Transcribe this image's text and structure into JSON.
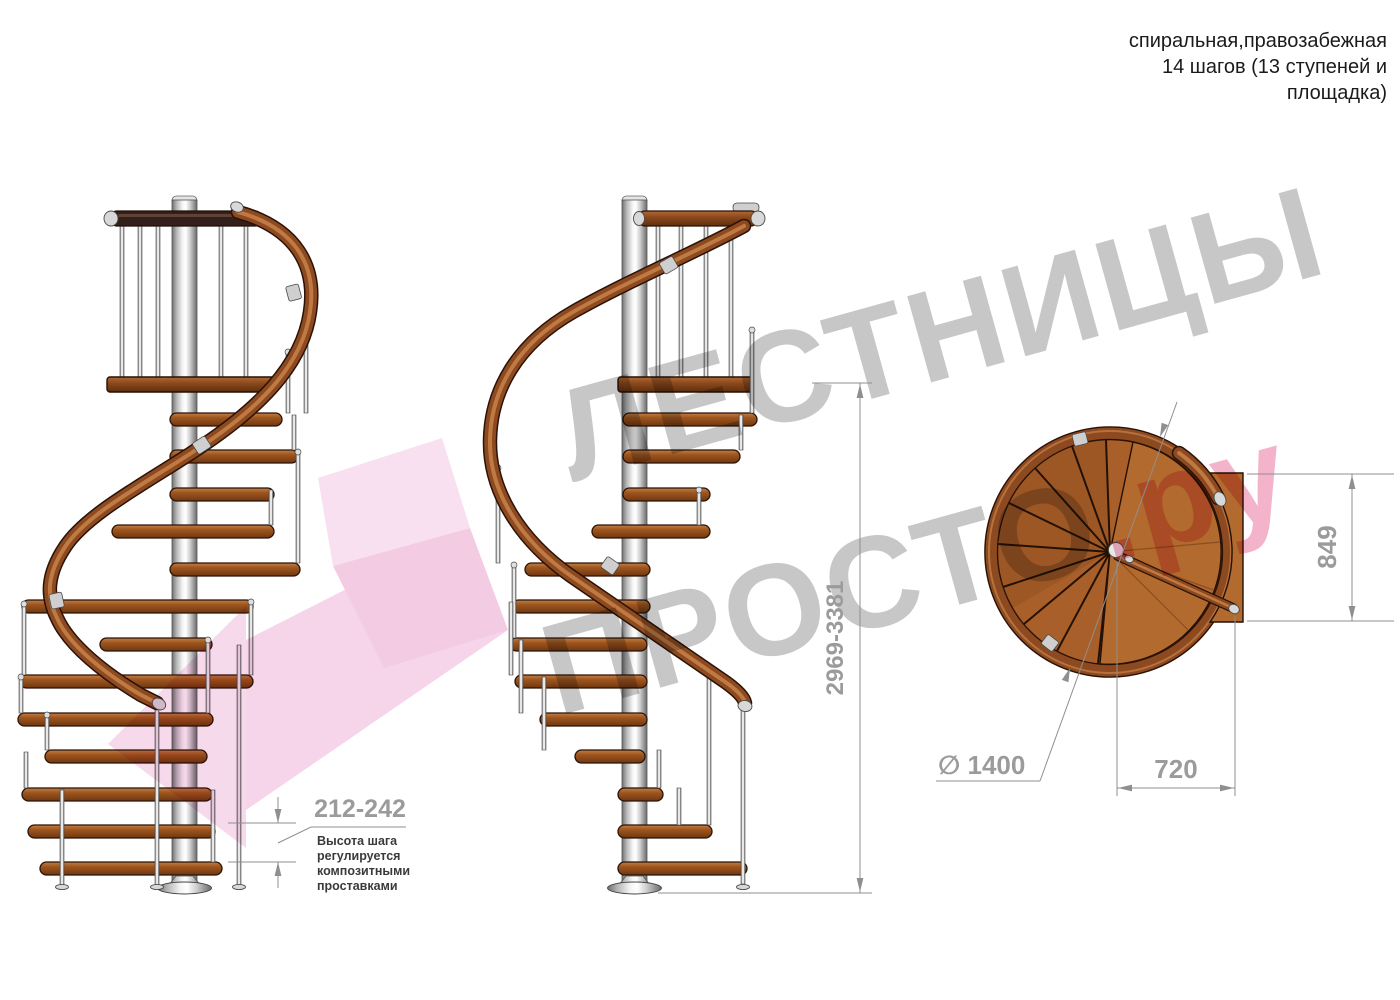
{
  "header": {
    "title_lines": [
      "спиральная,правозабежная",
      "14 шагов (13 ступеней и",
      "площадка)"
    ]
  },
  "watermark": {
    "line1": "ЛЕСТНИЦЫ",
    "line2": "ПРОСТО",
    "suffix": ".ру",
    "text_color": "#c7c7c7",
    "suffix_color": "#f3b3cb",
    "arrow_color": "#f6d4e9"
  },
  "dimensions": {
    "total_height": "2969-3381",
    "step_height": "212-242",
    "step_note_lines": [
      "Высота шага",
      "регулируется",
      "композитными",
      "проставками"
    ],
    "platform_depth": "849",
    "walkline_width": "720",
    "diameter": "∅ 1400"
  },
  "drawing": {
    "dim_text_color": "#9b9b9b",
    "dim_line_color": "#8f8f8f",
    "wood_color": "#a95f29",
    "rail_wood_color": "#8d4a20",
    "metal_color": "#c9c9c9"
  }
}
